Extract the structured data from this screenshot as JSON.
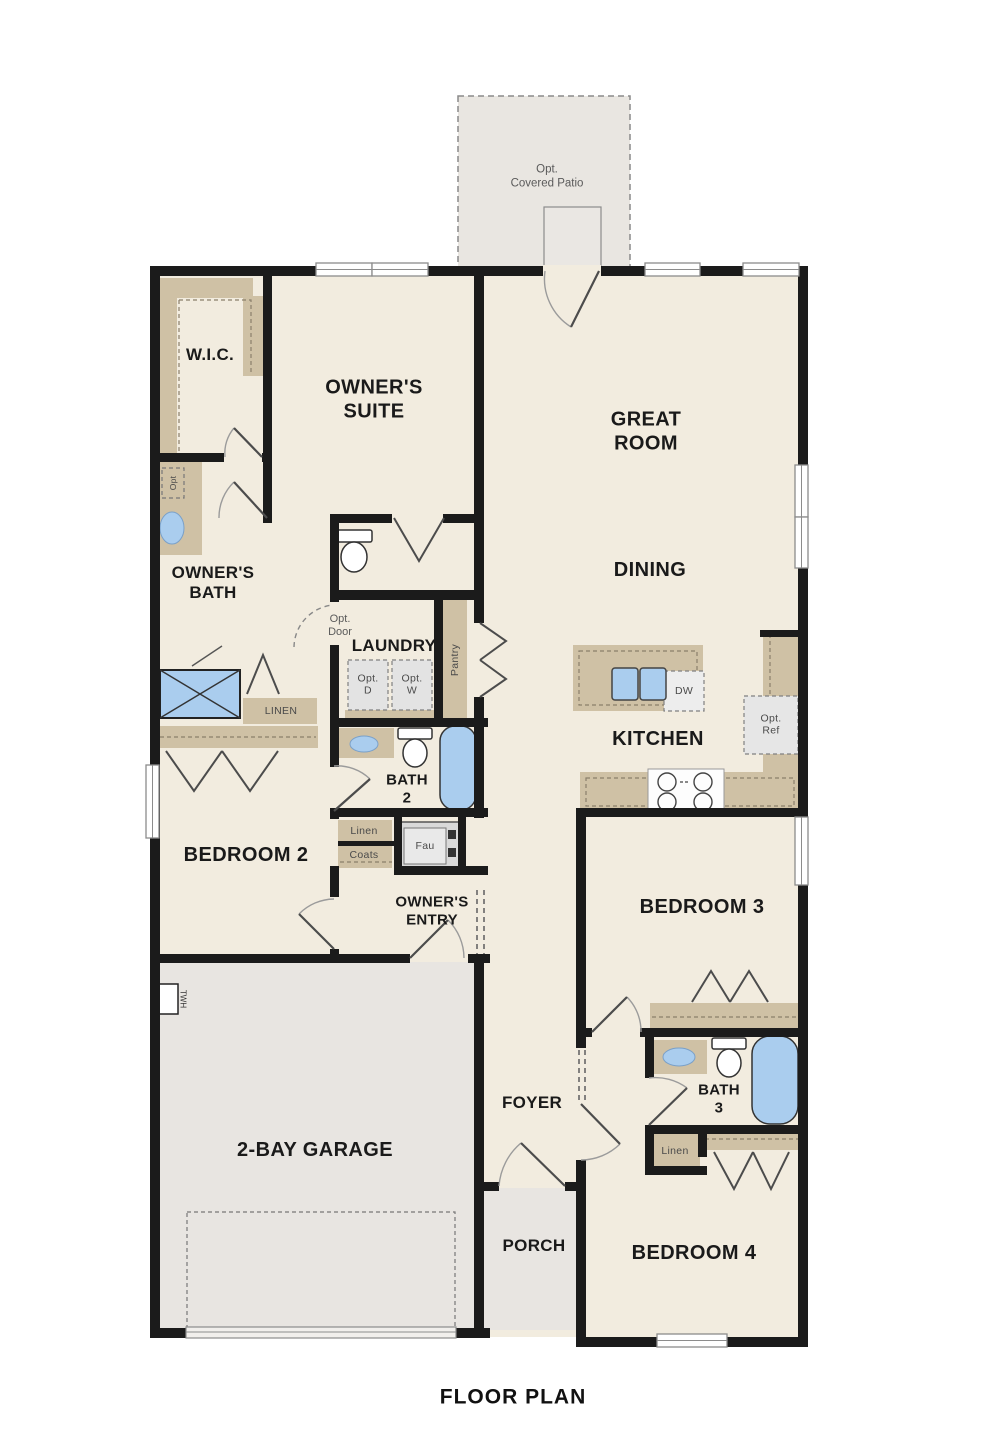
{
  "title": "FLOOR PLAN",
  "patio": {
    "label": "Opt.\nCovered Patio"
  },
  "rooms": {
    "wic": "W.I.C.",
    "owners_suite": "OWNER'S\nSUITE",
    "great_room": "GREAT\nROOM",
    "dining": "DINING",
    "owners_bath": "OWNER'S\nBATH",
    "laundry": "LAUNDRY",
    "kitchen": "KITCHEN",
    "bath2": "BATH\n2",
    "bedroom2": "BEDROOM 2",
    "owners_entry": "OWNER'S\nENTRY",
    "bedroom3": "BEDROOM 3",
    "bath3": "BATH\n3",
    "garage": "2-BAY GARAGE",
    "foyer": "FOYER",
    "porch": "PORCH",
    "bedroom4": "BEDROOM 4"
  },
  "fixtures": {
    "opt_door": "Opt.\nDoor",
    "pantry": "Pantry",
    "opt_d": "Opt.\nD",
    "opt_w": "Opt.\nW",
    "dw": "DW",
    "opt_ref": "Opt.\nRef",
    "linen_owner": "LINEN",
    "linen_hall": "Linen",
    "coats": "Coats",
    "fau": "Fau",
    "linen_bath3": "Linen",
    "twh": "TWH",
    "opt_vanity": "Opt"
  },
  "colors": {
    "floor": "#f2ecdf",
    "garage_floor": "#e8e5e1",
    "wall": "#1b1b1b",
    "cabinet": "#cfc1a5",
    "fixture_blue": "#aacdee",
    "appliance_gray": "#e4e4e4"
  }
}
